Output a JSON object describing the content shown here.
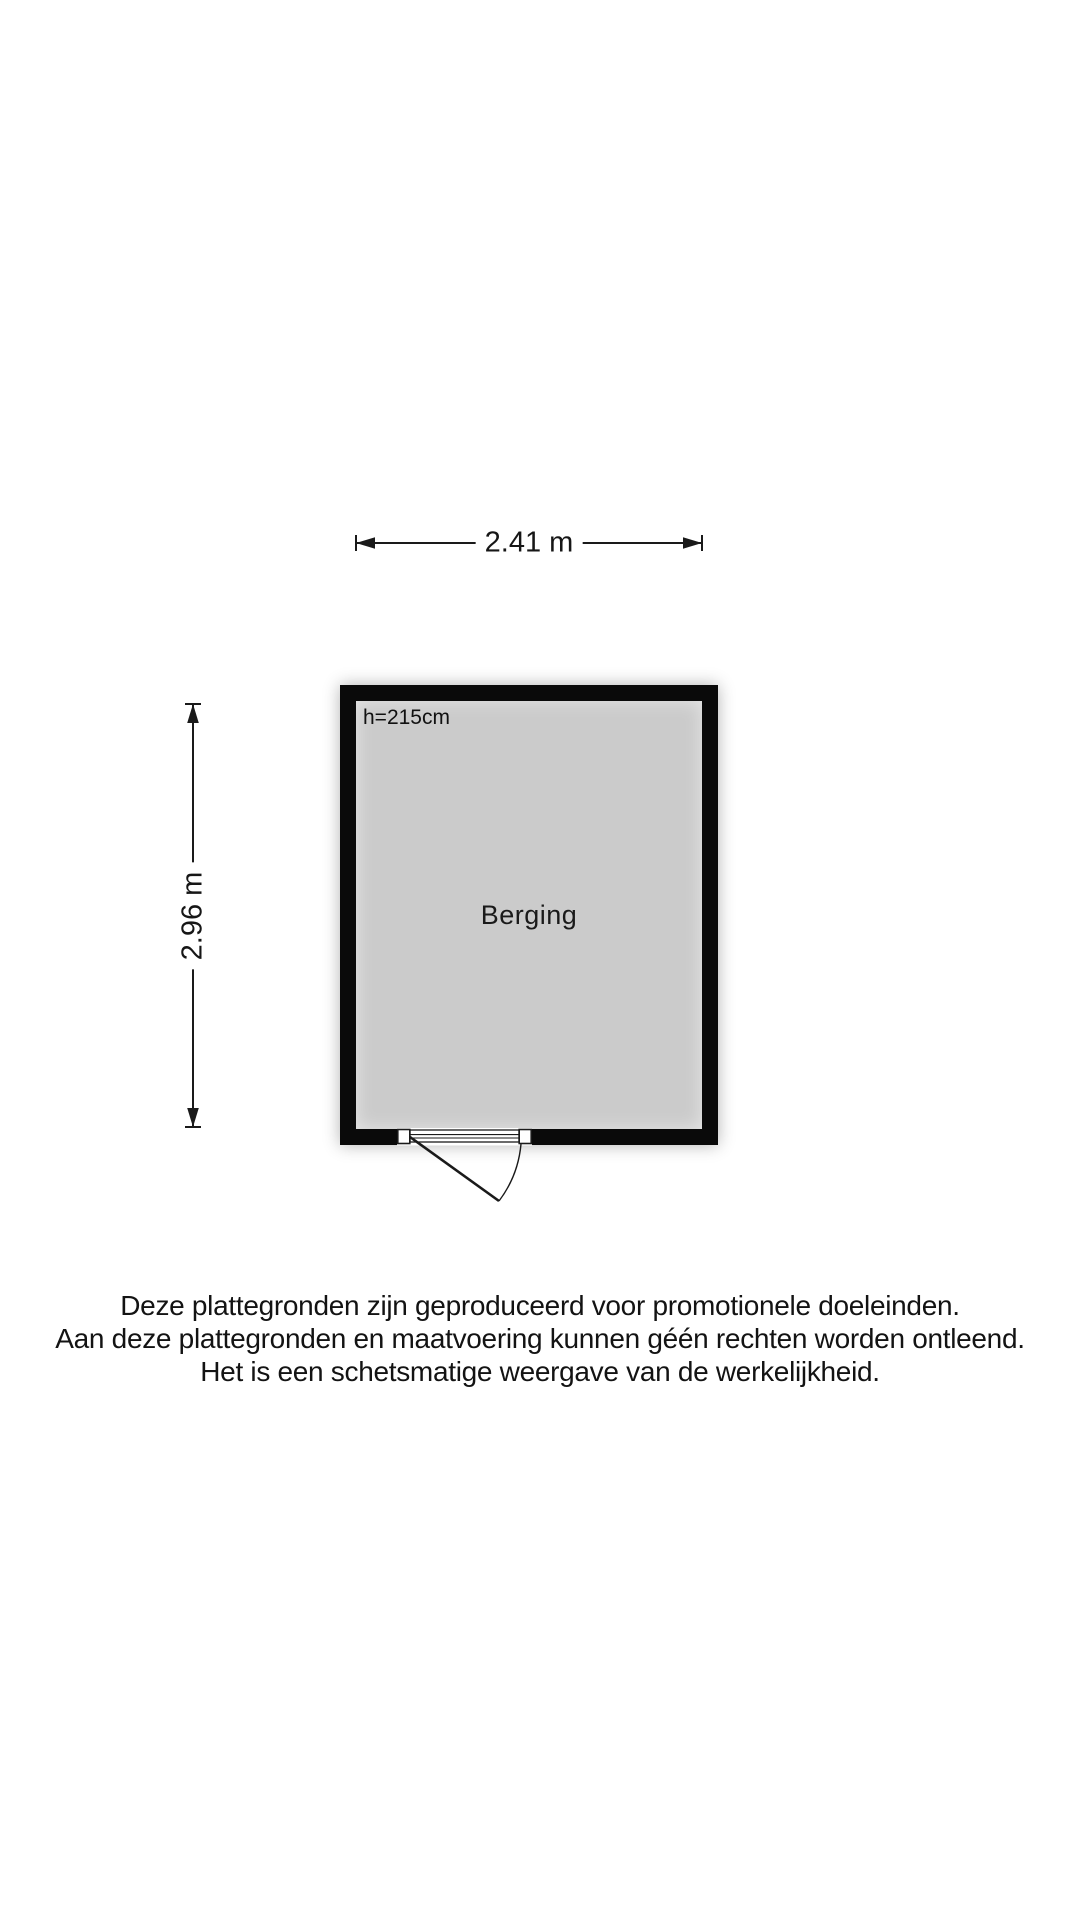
{
  "floorplan": {
    "room": {
      "name": "Berging",
      "ceiling_height_label": "h=215cm"
    },
    "dimensions": {
      "width_label": "2.41 m",
      "height_label": "2.96 m"
    },
    "disclaimer": {
      "line1": "Deze plattegronden zijn geproduceerd voor promotionele doeleinden.",
      "line2": "Aan deze plattegronden en maatvoering kunnen géén rechten worden ontleend.",
      "line3": "Het is een schetsmatige weergave van de werkelijkheid."
    },
    "colors": {
      "background": "#ffffff",
      "wall": "#0a0a0a",
      "floor": "#cbcbcb",
      "line": "#1a1a1a",
      "ink": "#111111"
    }
  }
}
